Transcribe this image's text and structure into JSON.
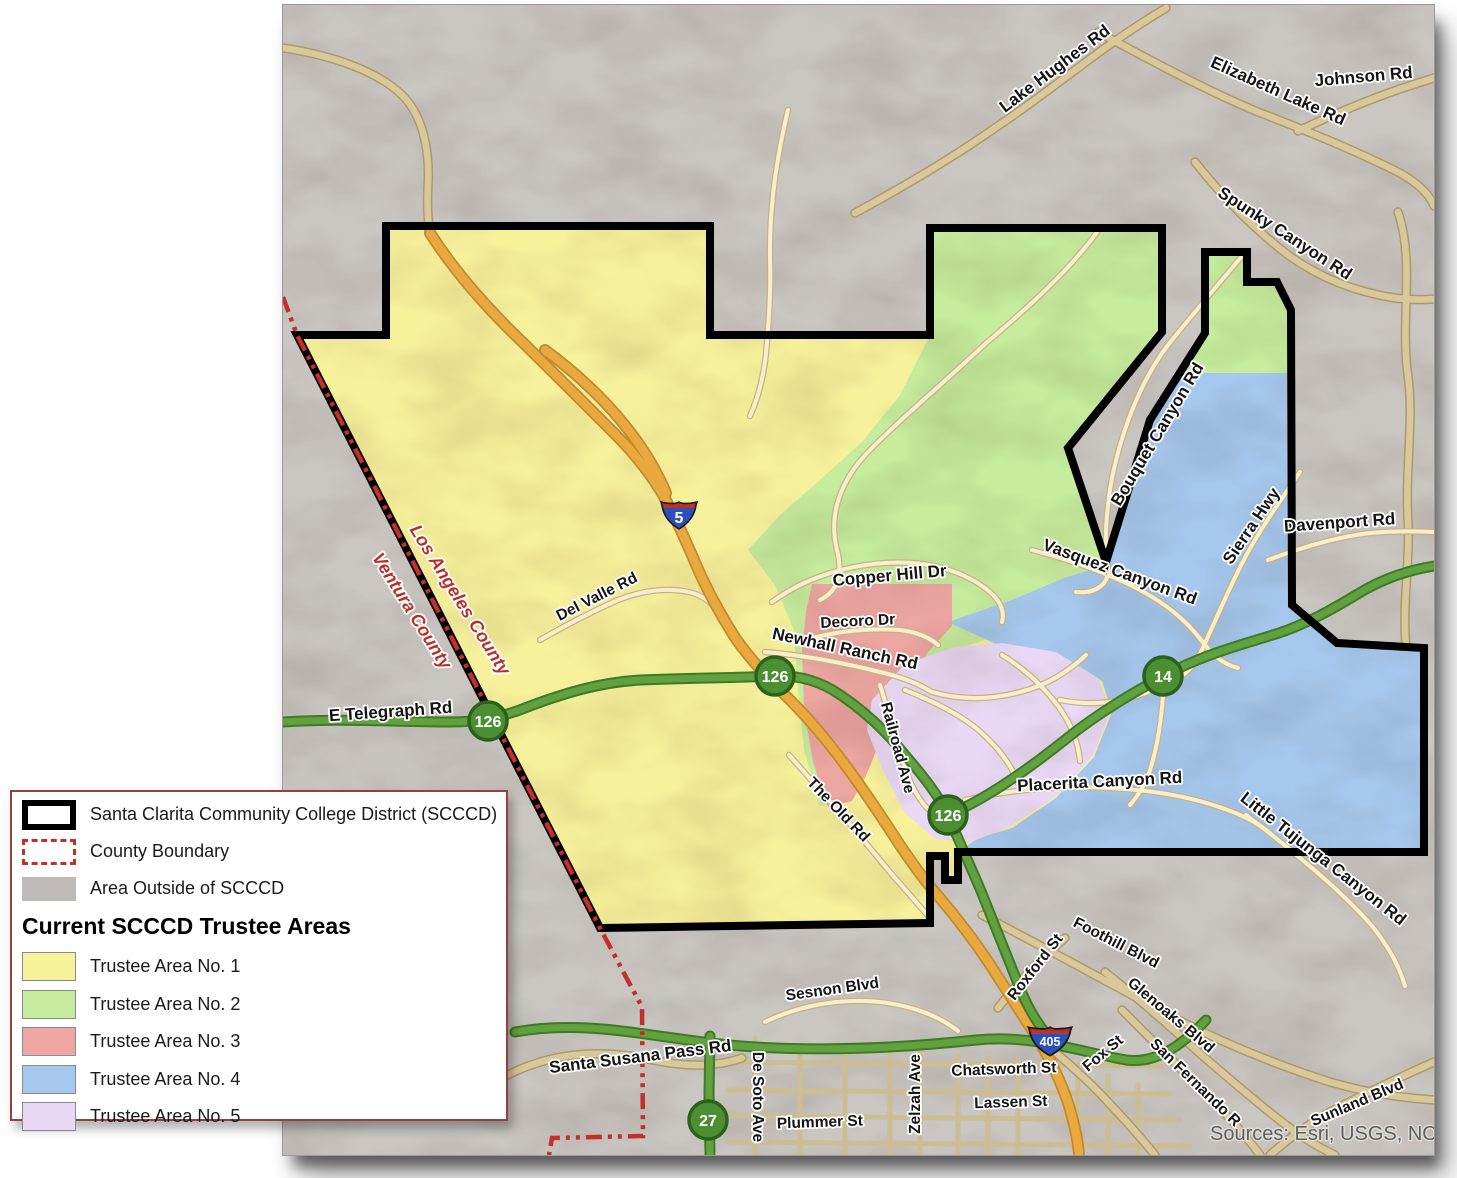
{
  "map": {
    "attribution": "Sources: Esri, USGS, NOAA",
    "county_labels": [
      {
        "text": "Los Angeles County"
      },
      {
        "text": "Ventura County"
      }
    ],
    "road_labels": [
      {
        "text": "Lake Hughes Rd"
      },
      {
        "text": "Elizabeth Lake Rd"
      },
      {
        "text": "Johnson Rd"
      },
      {
        "text": "Spunky Canyon Rd"
      },
      {
        "text": "Bouquet Canyon Rd"
      },
      {
        "text": "Vasquez Canyon Rd"
      },
      {
        "text": "Sierra Hwy"
      },
      {
        "text": "Davenport Rd"
      },
      {
        "text": "Copper Hill Dr"
      },
      {
        "text": "Decoro Dr"
      },
      {
        "text": "Newhall Ranch Rd"
      },
      {
        "text": "Del Valle Rd"
      },
      {
        "text": "E Telegraph Rd"
      },
      {
        "text": "Railroad Ave"
      },
      {
        "text": "The Old Rd"
      },
      {
        "text": "Placerita Canyon Rd"
      },
      {
        "text": "Little Tujunga Canyon Rd"
      },
      {
        "text": "Sesnon Blvd"
      },
      {
        "text": "Santa Susana Pass Rd"
      },
      {
        "text": "De Soto Ave"
      },
      {
        "text": "Plummer St"
      },
      {
        "text": "Zelzah Ave"
      },
      {
        "text": "Chatsworth St"
      },
      {
        "text": "Lassen St"
      },
      {
        "text": "Roxford St"
      },
      {
        "text": "Foothill Blvd"
      },
      {
        "text": "Glenoaks Blvd"
      },
      {
        "text": "Fox St"
      },
      {
        "text": "San Fernando R"
      },
      {
        "text": "Sunland Blvd"
      }
    ],
    "shields": {
      "green": [
        "126",
        "126",
        "126",
        "14",
        "27"
      ],
      "interstate": [
        "5",
        "405"
      ]
    },
    "colors": {
      "trustee_area_1": "#f7f19c",
      "trustee_area_2": "#c6ec9d",
      "trustee_area_3": "#eda6a2",
      "trustee_area_4": "#a6c8ee",
      "trustee_area_5": "#ead9f6",
      "area_outside": "#bdbab7",
      "district_boundary": "#000000",
      "county_boundary": "#c2302a",
      "highway_green": "#61a13e",
      "interstate_orange": "#e9a93f",
      "road_fill": "#f8eecb"
    }
  },
  "legend": {
    "items": [
      {
        "label": "Santa Clarita Community College District (SCCCD)"
      },
      {
        "label": "County Boundary"
      },
      {
        "label": "Area Outside of SCCCD"
      }
    ],
    "heading": "Current SCCCD Trustee Areas",
    "areas": [
      {
        "label": "Trustee Area No. 1",
        "color": "#f7f19c"
      },
      {
        "label": "Trustee Area No. 2",
        "color": "#c6ec9d"
      },
      {
        "label": "Trustee Area No. 3",
        "color": "#eda6a2"
      },
      {
        "label": "Trustee Area No. 4",
        "color": "#a6c8ee"
      },
      {
        "label": "Trustee Area No. 5",
        "color": "#ead9f6"
      }
    ]
  }
}
